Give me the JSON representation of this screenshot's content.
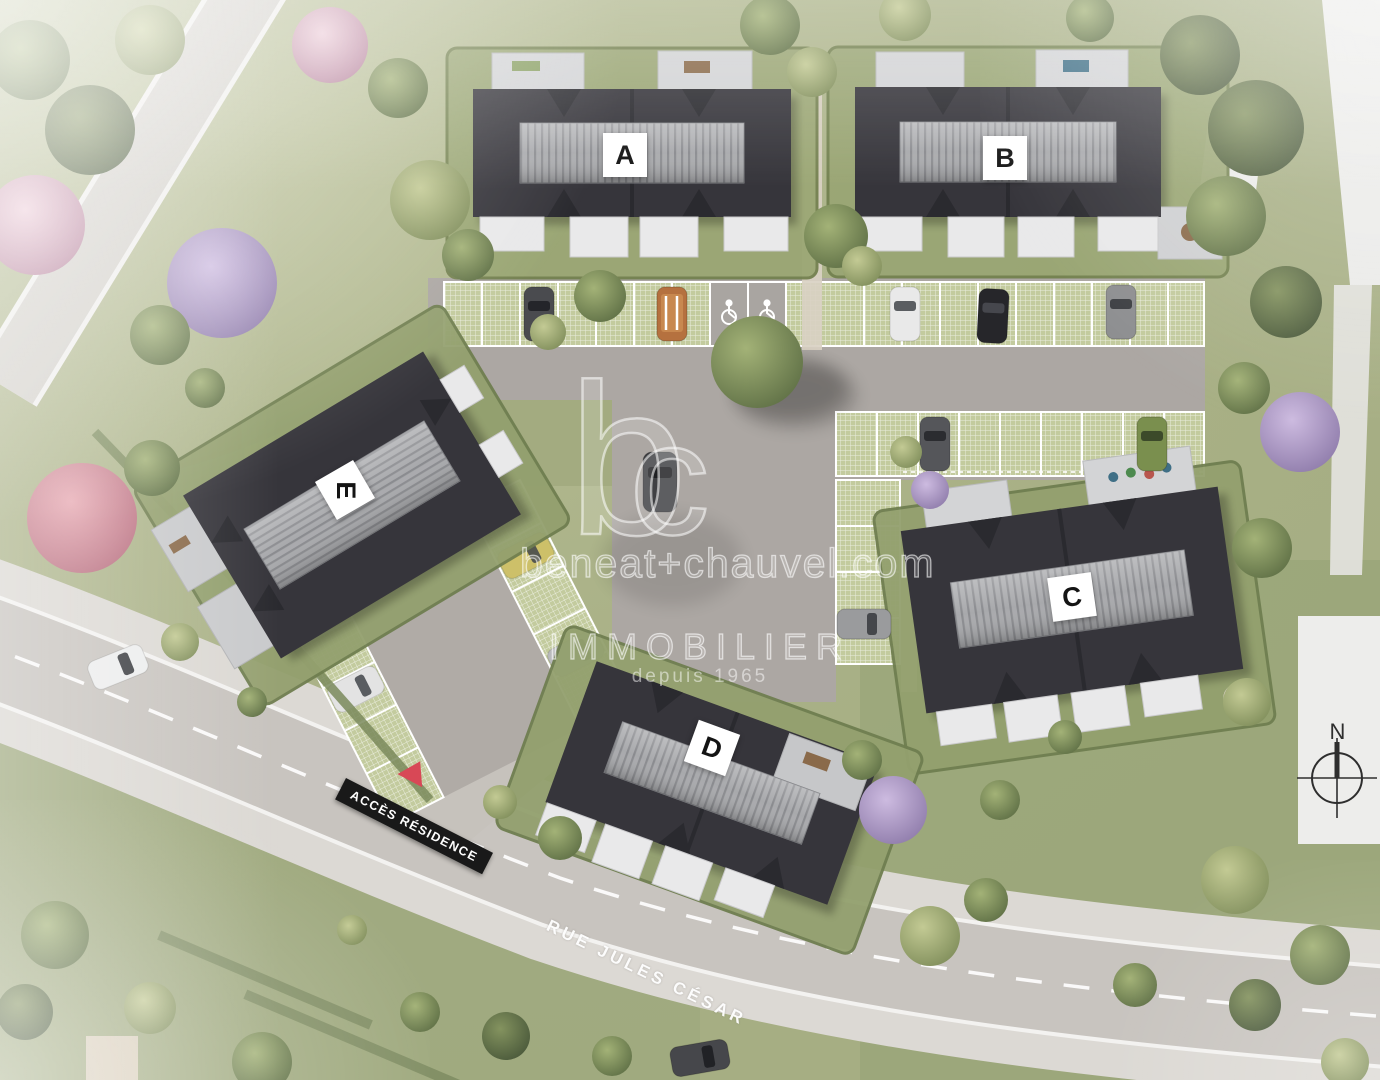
{
  "site": {
    "buildings": [
      {
        "id": "A",
        "label": "A"
      },
      {
        "id": "B",
        "label": "B"
      },
      {
        "id": "C",
        "label": "C"
      },
      {
        "id": "D",
        "label": "D"
      },
      {
        "id": "E",
        "label": "E"
      }
    ],
    "watermark": {
      "logo_b": "b",
      "logo_c": "c",
      "domain": "beneat+chauvel.com",
      "brand": "IMMOBILIER",
      "since": "depuis 1965"
    },
    "street": {
      "name": "RUE JULES CÉSAR"
    },
    "access_sign": {
      "label": "ACCÈS RÉSIDENCE"
    },
    "compass": {
      "north": "N"
    },
    "colors": {
      "roof": "#36353b",
      "roof_band": "#a7a8ab",
      "lawn": "#a6ae83",
      "road": "#c8c4bf",
      "sidewalk": "#dcd9d4",
      "stall_green": "#c3cb9e",
      "banner_black": "#191919",
      "accent_red": "#d84856",
      "white_terrace": "#e9e9ea"
    }
  }
}
